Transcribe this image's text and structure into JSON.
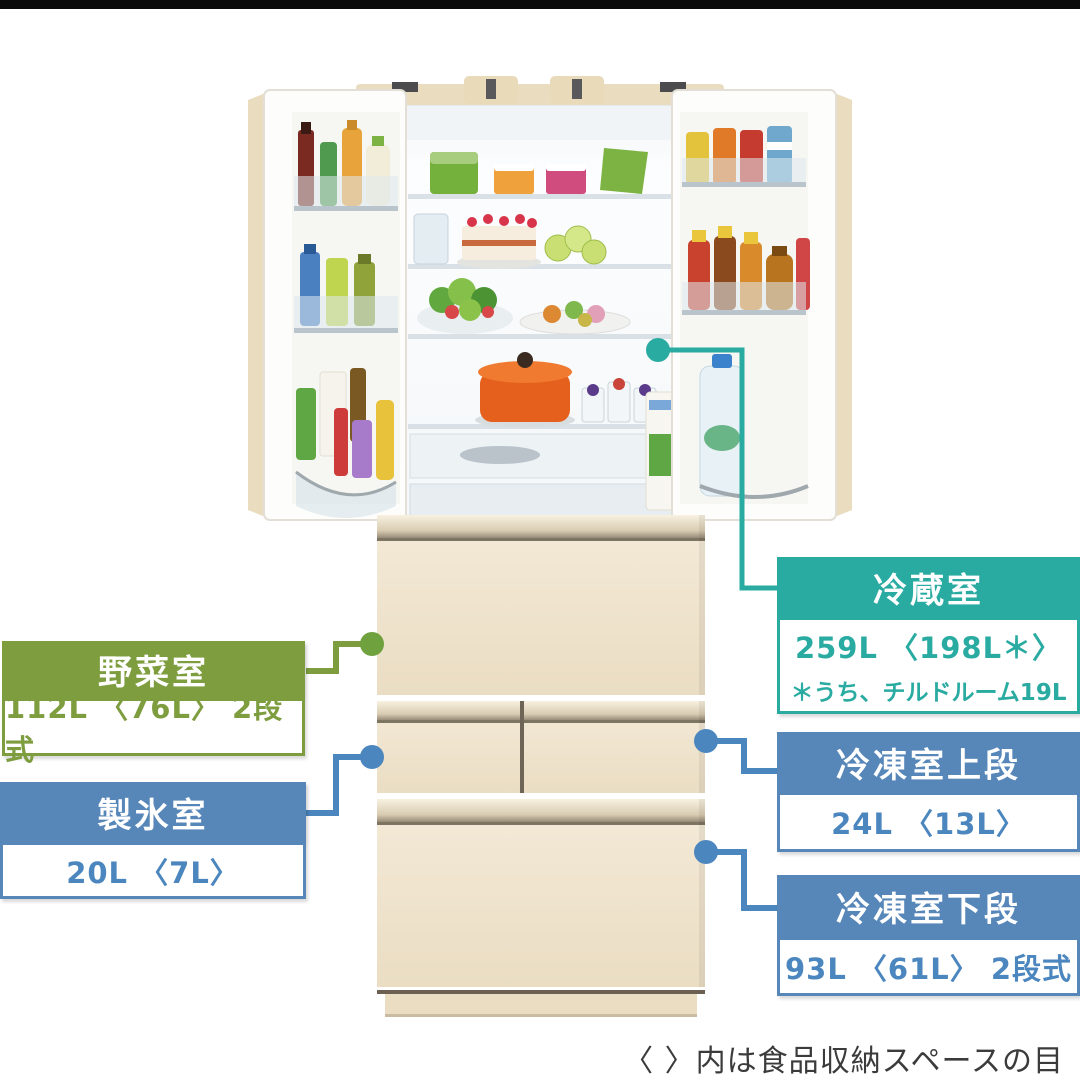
{
  "footnote": "〈 〉内は食品収納スペースの目安",
  "colors": {
    "teal": "#2aaba2",
    "green": "#7d9d3e",
    "blue": "#5787b9",
    "cabinet": "#efe4ce"
  },
  "labels": {
    "vegetable": {
      "title": "野菜室",
      "capacity": "112L 〈76L〉 2段式"
    },
    "ice": {
      "title": "製氷室",
      "capacity": "20L 〈7L〉"
    },
    "refrigerator": {
      "title": "冷蔵室",
      "capacity": "259L 〈198L＊〉",
      "note": "＊うち、チルドルーム19L"
    },
    "freezer_upper": {
      "title": "冷凍室上段",
      "capacity": "24L 〈13L〉"
    },
    "freezer_lower": {
      "title": "冷凍室下段",
      "capacity": "93L 〈61L〉 2段式"
    }
  }
}
